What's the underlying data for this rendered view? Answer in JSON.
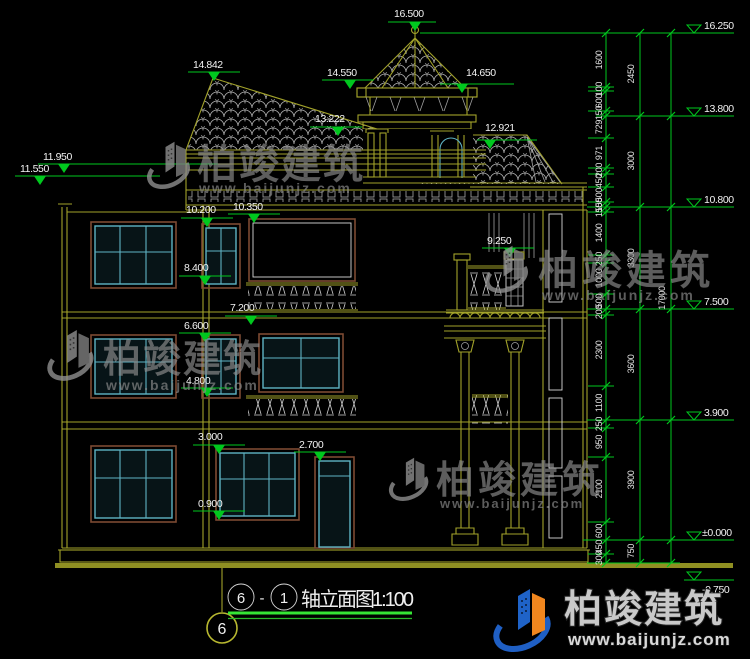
{
  "drawing": {
    "title": {
      "bubble_left": "6",
      "separator": "-",
      "bubble_right": "1",
      "name": "轴立面图",
      "scale": "1:100"
    },
    "axis_bubble": "6",
    "watermark": {
      "brand": "柏竣建筑",
      "url": "www.baijunjz.com"
    },
    "left_marks": [
      "16.500",
      "14.842",
      "14.550",
      "14.650",
      "13.222",
      "12.921",
      "11.950",
      "11.550",
      "10.200",
      "10.350",
      "9.250",
      "8.400",
      "7.200",
      "6.600",
      "4.800",
      "3.000",
      "2.700",
      "0.900"
    ],
    "right_marks": [
      "16.250",
      "13.800",
      "10.800",
      "7.500",
      "3.900",
      "±0.000",
      "-0.750"
    ],
    "dim_chain_inner": [
      "1600",
      "100",
      "600",
      "150",
      "729",
      "971",
      "200",
      "450",
      "500",
      "150",
      "150",
      "1400",
      "250",
      "1000",
      "500",
      "200",
      "2300",
      "1100",
      "250",
      "950",
      "2100",
      "600",
      "450",
      "300"
    ],
    "dim_chain_mid": [
      "2450",
      "3000",
      "3300",
      "3600",
      "3900",
      "750"
    ],
    "dim_chain_outer": [
      "17000"
    ],
    "colors": {
      "line": "#a2a22a",
      "dim": "#00c81e",
      "window": "#5fb3c4",
      "frame": "#7c4a33",
      "tile": "#b0b0b0",
      "logo_blue": "#1f63c8",
      "logo_orange": "#f0861e"
    }
  }
}
